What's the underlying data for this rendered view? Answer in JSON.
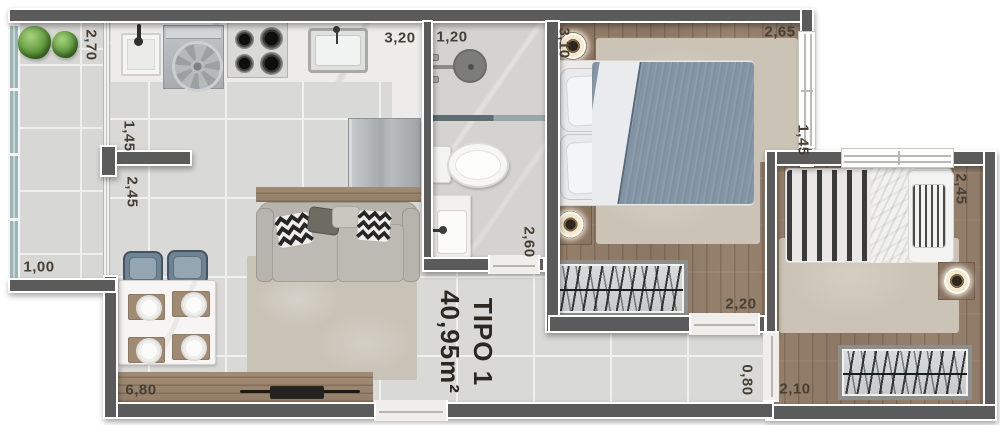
{
  "plan": {
    "title": {
      "line1": "TIPO 1",
      "line2": "40,95m²"
    },
    "dimensions": {
      "balcony_length": "2,70",
      "partition_upper": "1,45",
      "partition_lower": "2,45",
      "balcony_width": "1,00",
      "living_length": "6,80",
      "kitchen_length": "3,20",
      "bath_width": "1,20",
      "bath_length": "2,60",
      "bed1_length": "3,10",
      "bed1_width": "2,65",
      "bed1_window": "1,45",
      "bed2_length": "2,45",
      "wardrobe1": "2,20",
      "hall_door": "0,80",
      "wardrobe2": "2,10"
    }
  },
  "colors": {
    "wall": "#5b5b5b",
    "tile": "#d9d9d7",
    "grout": "#f0f0ee",
    "wood": "#95806b",
    "glass": "#9db5b6",
    "duvet": "#8496a6",
    "rug": "#cbc3b5",
    "label": "#473f35"
  }
}
